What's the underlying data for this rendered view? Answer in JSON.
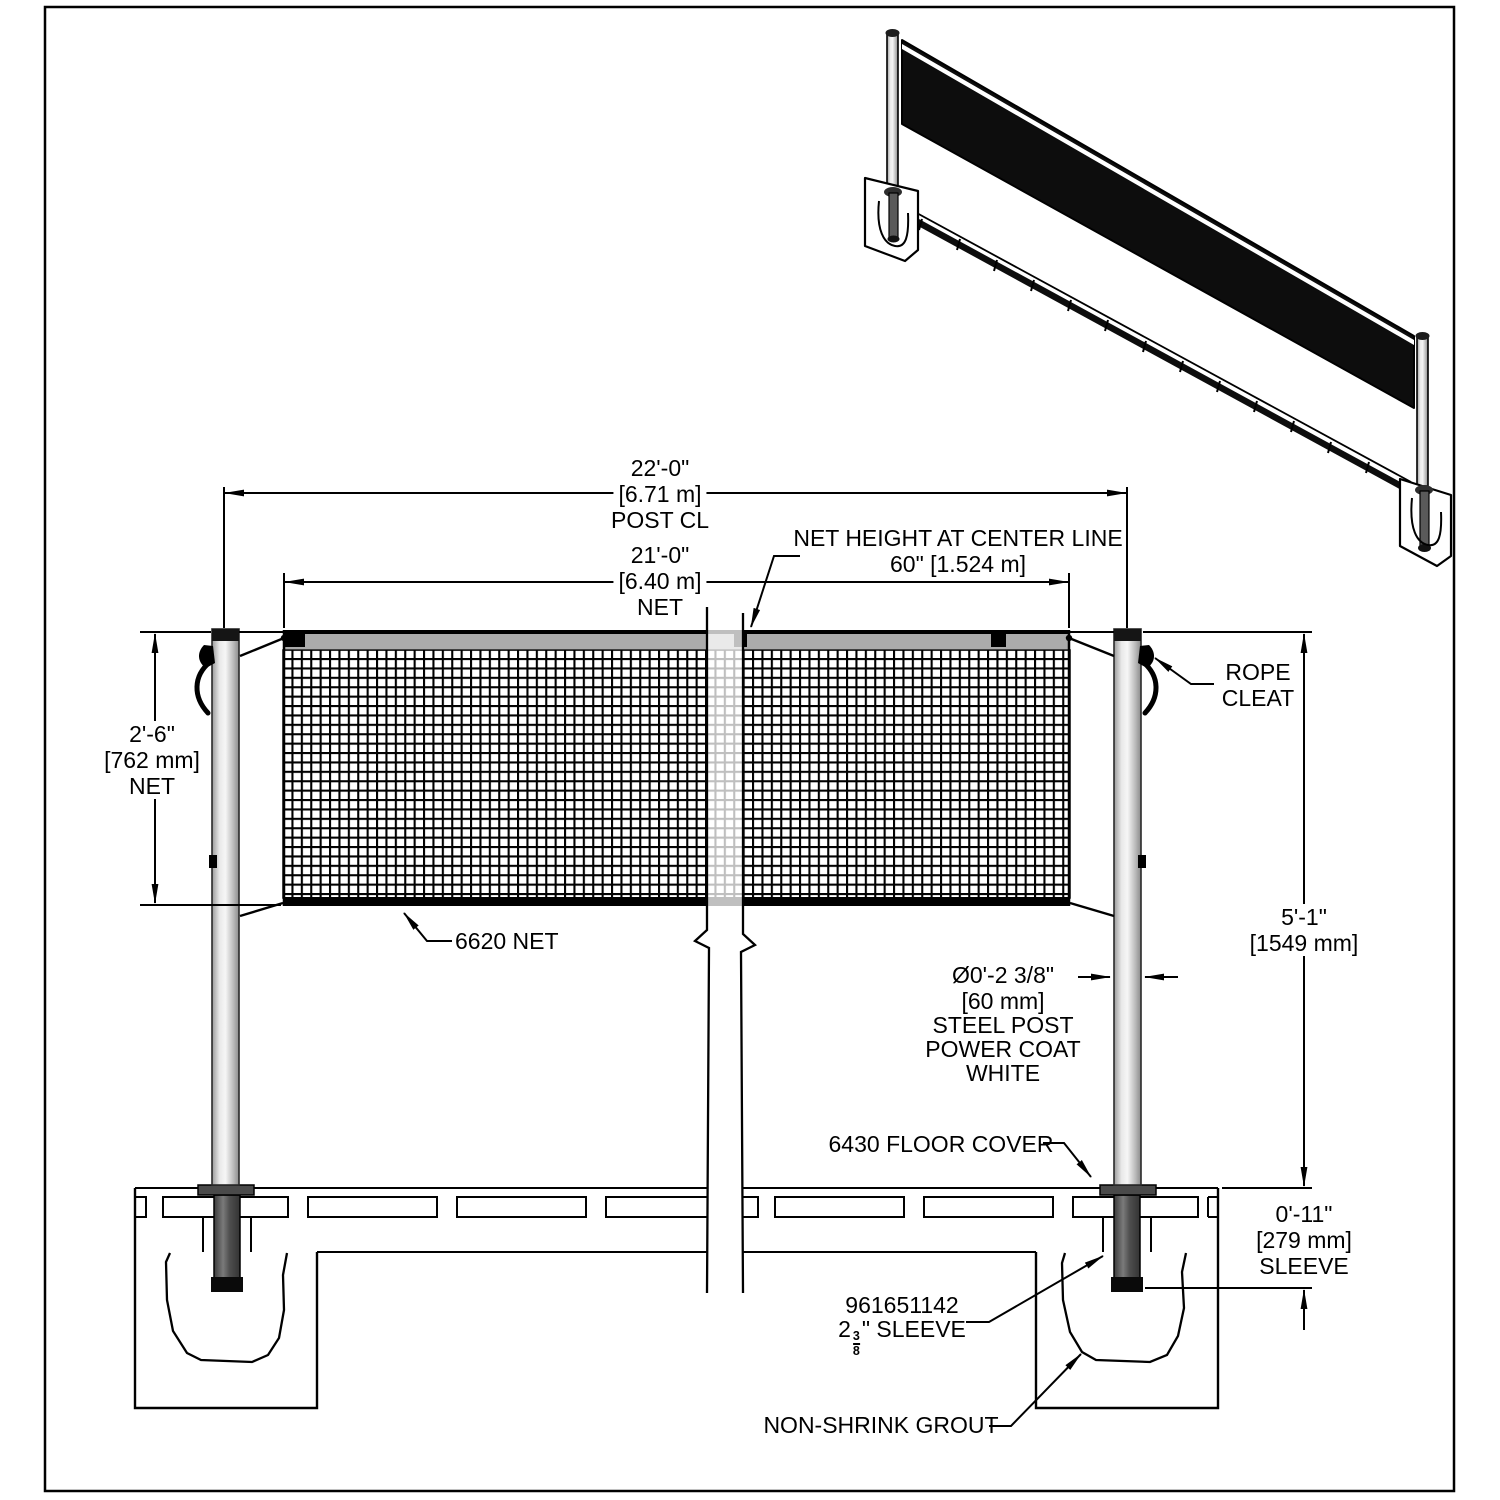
{
  "dimensions": {
    "post_centerline": {
      "value": "22'-0\"",
      "metric": "[6.71 m]",
      "label": "POST CL"
    },
    "net_width": {
      "value": "21'-0\"",
      "metric": "[6.40 m]",
      "label": "NET"
    },
    "net_height_at_center": {
      "label": "NET HEIGHT AT CENTER LINE",
      "value": "60\" [1.524 m]"
    },
    "net_depth": {
      "value": "2'-6\"",
      "metric": "[762 mm]",
      "label": "NET"
    },
    "post_height": {
      "value": "5'-1\"",
      "metric": "[1549 mm]"
    },
    "sleeve_depth": {
      "value": "0'-11\"",
      "metric": "[279 mm]",
      "label": "SLEEVE"
    },
    "post_diameter": {
      "value": "Ø0'-2 3/8\"",
      "metric": "[60 mm]",
      "lines": [
        "STEEL POST",
        "POWER COAT",
        "WHITE"
      ]
    }
  },
  "callouts": {
    "rope_cleat": {
      "line1": "ROPE",
      "line2": "CLEAT"
    },
    "net_part": "6620 NET",
    "floor_cover": "6430 FLOOR COVER",
    "sleeve": {
      "part_number": "961651142",
      "pre": "2",
      "frac_num": "3",
      "frac_den": "8",
      "post": "\" SLEEVE"
    },
    "grout": "NON-SHRINK GROUT"
  },
  "colors": {
    "line": "#000000",
    "net_tape": "#ababab",
    "post_light": "#e8e8e8",
    "sleeve_dark": "#4a4a4a"
  }
}
